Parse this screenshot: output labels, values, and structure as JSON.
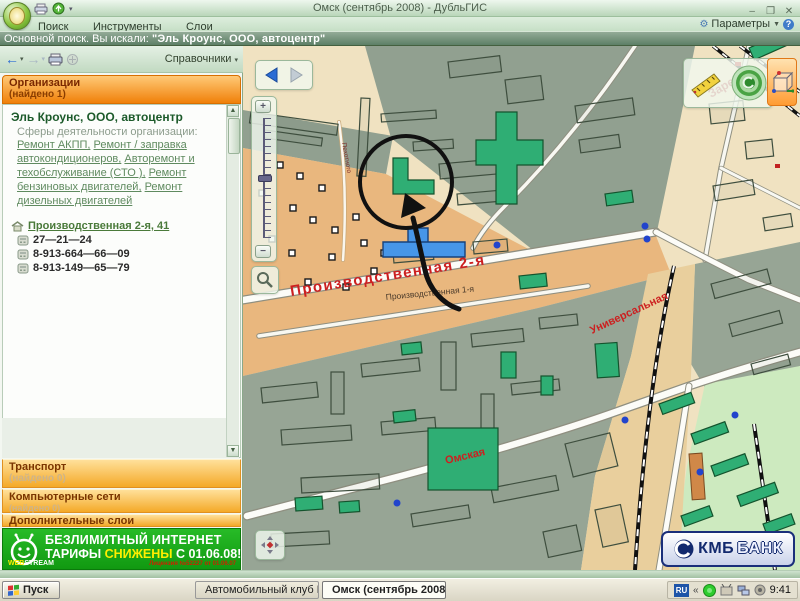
{
  "window": {
    "title": "Омск (сентябрь 2008) - ДубльГИС",
    "minimize": "–",
    "maximize": "❐",
    "close": "✕"
  },
  "menu": {
    "items": [
      "Поиск",
      "Инструменты",
      "Слои"
    ],
    "params_label": "Параметры",
    "help_glyph": "?"
  },
  "search_bar": {
    "text": "Основной поиск. Вы искали:",
    "query": "\"Эль Кроунс, ООО, автоцентр\""
  },
  "sidebar": {
    "toolbar": {
      "directories_label": "Справочники"
    },
    "group": {
      "title": "Организации",
      "count": "(найдено 1)"
    },
    "org": {
      "name": "Эль Кроунс, ООО, автоцентр",
      "activities_label": "Сферы деятельности организации:",
      "activities": [
        "Ремонт АКПП,",
        "Ремонт / заправка автокондиционеров,",
        "Авторемонт и техобслуживание (СТО ),",
        "Ремонт бензиновых двигателей,",
        "Ремонт дизельных двигателей"
      ],
      "address": "Производственная 2-я, 41",
      "phones": [
        "27—21—24",
        "8-913-664—66—09",
        "8-913-149—65—79"
      ]
    },
    "panels": [
      {
        "title": "Транспорт",
        "count": "(найдено 0)"
      },
      {
        "title": "Компьютерные сети",
        "count": "(найдено 0)"
      },
      {
        "title": "Дополнительные слои",
        "count": ""
      }
    ],
    "banner": {
      "line1": "БЕЗЛИМИТНЫЙ ИНТЕРНЕТ",
      "tariffs": "ТАРИФЫ ",
      "highlight": "СНИЖЕНЫ",
      "date": " С 01.06.08!",
      "web": "WEB",
      "stream": "STREAM",
      "license": "Лицензия №52227 от 01.06.07"
    }
  },
  "map": {
    "streets": {
      "prod2": "Производственная 2-я",
      "prod1": "Производственная 1-я",
      "univ": "Универсальная",
      "omsk": "Омская",
      "zarech": "Заречье",
      "small": "Пехотного"
    },
    "kmb": {
      "prefix": "КМБ",
      "suffix": "БАНК"
    }
  },
  "taskbar": {
    "start": "Пуск",
    "task1": "Автомобильный клуб П...",
    "task2": "Омск (сентябрь 2008...",
    "tray_lang": "RU",
    "tray_chevron": "«",
    "clock": "9:41"
  },
  "colors": {
    "accent_orange": "#f08009",
    "banner_green": "#1db31d",
    "map_building_green": "#2fae74",
    "map_tan": "#e9b77e",
    "map_gray": "#91a090",
    "street_red": "#cc2020",
    "link_green": "#5f8a5f"
  }
}
